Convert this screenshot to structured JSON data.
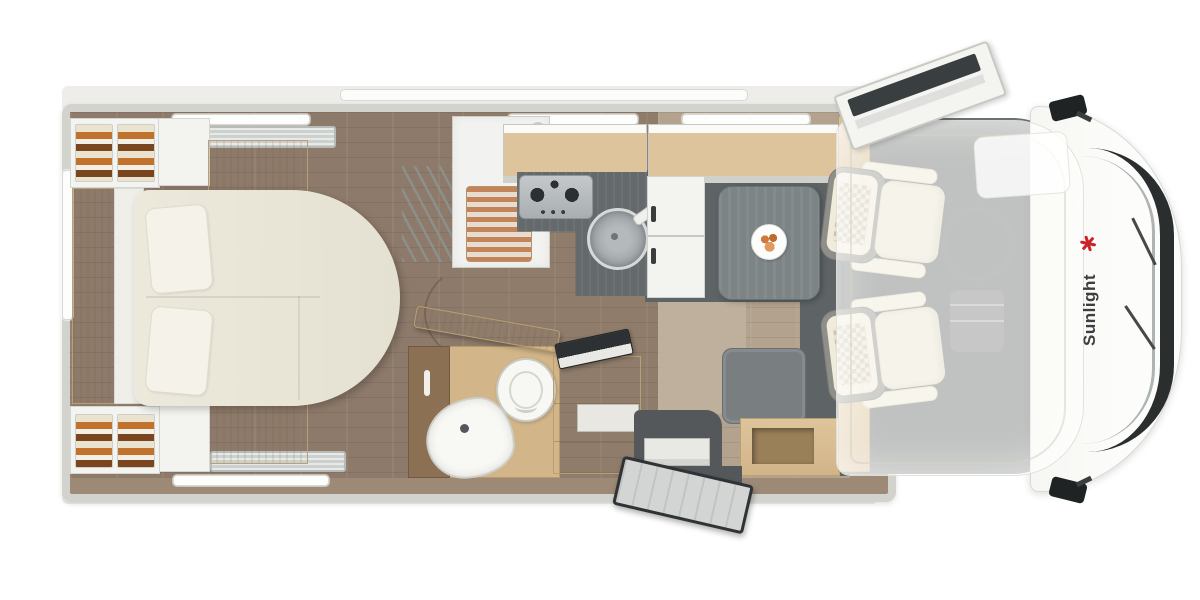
{
  "brand": {
    "logo_text": "Sunlight"
  },
  "palette": {
    "page-bg": "#ffffff",
    "roof": "#eeede9",
    "wall": "#d3d3ce",
    "floor-dark": "#8d7a6a",
    "floor-mid": "#8f7c6b",
    "floor-light": "#b2a28e",
    "floor-charcoal": "#5e6466",
    "cab-floor": "#6b7072",
    "wood": "#dec49c",
    "wood-dark": "#b99f74",
    "bath-wood": "#8b7053",
    "counter": "#646a6c",
    "table": "#7c8486",
    "seat-gray": "#797f81",
    "cream": "#ece7d9",
    "white-furn": "#f3f3f0",
    "skylight": "#ccd1ce",
    "teak": "#c3845a",
    "glass-dark": "#393e40",
    "windshield": "#2b2e2f",
    "clothes-orange": "#c1722d",
    "clothes-brown": "#7a4620",
    "food": "#d0793f",
    "brand-red": "#c9222a",
    "logo-text": "#3e3e3e"
  },
  "floorplan": {
    "zones": [
      {
        "id": "rear-bedroom",
        "label": "Rear bedroom"
      },
      {
        "id": "island-bed",
        "label": "Island bed with pillows"
      },
      {
        "id": "wardrobe-top",
        "label": "Wardrobe with clothes"
      },
      {
        "id": "wardrobe-bottom",
        "label": "Wardrobe with clothes"
      },
      {
        "id": "shower",
        "label": "Shower cabin with teak mat"
      },
      {
        "id": "bathroom",
        "label": "Washroom with toilet and corner basin"
      },
      {
        "id": "kitchen",
        "label": "Kitchen block with 3-burner hob and round sink"
      },
      {
        "id": "refrigerator",
        "label": "Refrigerator tower"
      },
      {
        "id": "dinette",
        "label": "Dinette with table and bench seat"
      },
      {
        "id": "entrance",
        "label": "Entrance door with step"
      },
      {
        "id": "cab",
        "label": "Driver cab with two swivel seats"
      },
      {
        "id": "overcab-bed",
        "label": "Pull-down over-cab bed"
      },
      {
        "id": "front",
        "label": "Vehicle front with windshield and mirrors"
      }
    ]
  }
}
